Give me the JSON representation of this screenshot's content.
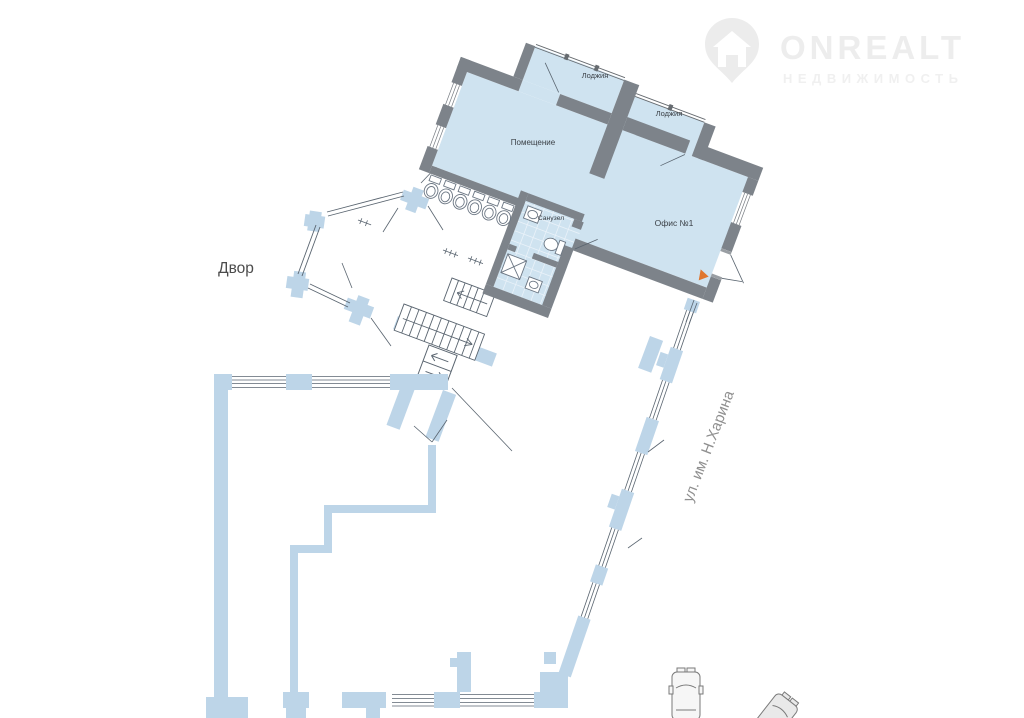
{
  "watermark": {
    "brand": "ONREALT",
    "subtitle": "НЕДВИЖИМОСТЬ",
    "pin_color": "#ececec",
    "brand_color": "#ededed",
    "subtitle_color": "#f0f0f0"
  },
  "floor_plan": {
    "rooms": {
      "loggia1": {
        "label": "Лоджия"
      },
      "loggia2": {
        "label": "Лоджия"
      },
      "main_room": {
        "label": "Помещение"
      },
      "bathroom": {
        "label": "Санузел"
      },
      "office": {
        "label": "Офис №1"
      }
    },
    "outside_labels": {
      "courtyard": "Двор",
      "street": "ул. им. Н.Харина"
    },
    "colors": {
      "unit_wall": "#7d838a",
      "unit_floor": "#cfe3f0",
      "building_wall": "#bdd5e8",
      "thin_line": "#5a6570",
      "entrance_marker": "#e0762e"
    }
  }
}
